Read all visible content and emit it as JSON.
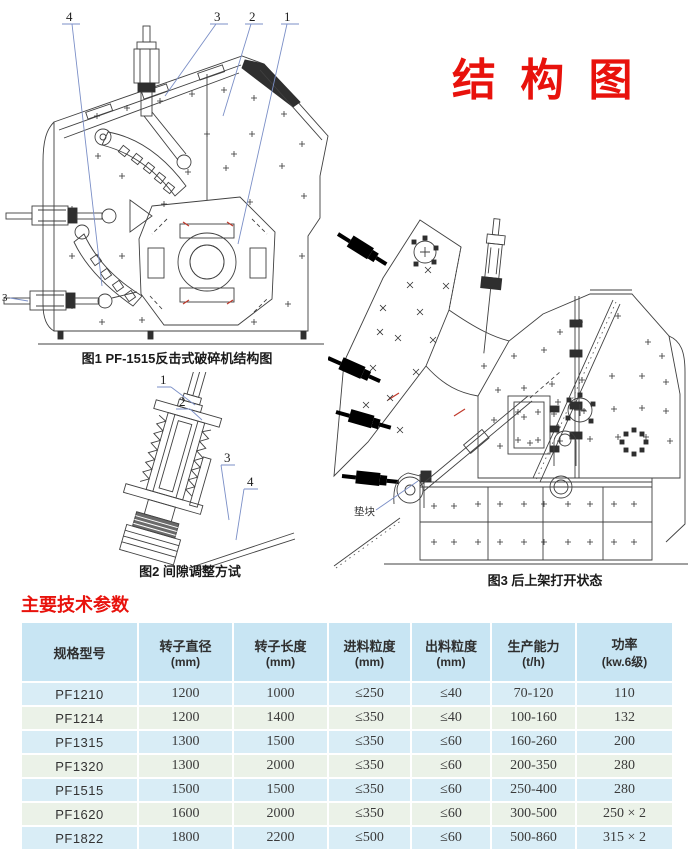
{
  "title": "结 构 图",
  "figures": {
    "fig1": {
      "caption": "图1 PF-1515反击式破碎机结构图",
      "callout_4": "4",
      "callout_3": "3",
      "callout_2": "2",
      "callout_1": "1",
      "callout_left_3": "3"
    },
    "fig2": {
      "caption": "图2 间隙调整方试",
      "callout_1": "1",
      "callout_2": "2",
      "callout_3": "3",
      "callout_4": "4"
    },
    "fig3": {
      "caption": "图3 后上架打开状态",
      "pad_label": "垫块"
    }
  },
  "section_heading": "主要技术参数",
  "table": {
    "headers": [
      {
        "title": "规格型号",
        "unit": ""
      },
      {
        "title": "转子直径",
        "unit": "(mm)"
      },
      {
        "title": "转子长度",
        "unit": "(mm)"
      },
      {
        "title": "进料粒度",
        "unit": "(mm)"
      },
      {
        "title": "出料粒度",
        "unit": "(mm)"
      },
      {
        "title": "生产能力",
        "unit": "(t/h)"
      },
      {
        "title": "功率",
        "unit": "(kw.6级)"
      }
    ],
    "rows": [
      [
        "PF1210",
        "1200",
        "1000",
        "≤250",
        "≤40",
        "70-120",
        "110"
      ],
      [
        "PF1214",
        "1200",
        "1400",
        "≤350",
        "≤40",
        "100-160",
        "132"
      ],
      [
        "PF1315",
        "1300",
        "1500",
        "≤350",
        "≤60",
        "160-260",
        "200"
      ],
      [
        "PF1320",
        "1300",
        "2000",
        "≤350",
        "≤60",
        "200-350",
        "280"
      ],
      [
        "PF1515",
        "1500",
        "1500",
        "≤350",
        "≤60",
        "250-400",
        "280"
      ],
      [
        "PF1620",
        "1600",
        "2000",
        "≤350",
        "≤60",
        "300-500",
        "250 × 2"
      ],
      [
        "PF1822",
        "1800",
        "2200",
        "≤500",
        "≤60",
        "500-860",
        "315 × 2"
      ]
    ]
  },
  "colors": {
    "accent_red": "#e8120c",
    "table_header_bg": "#c8e5f3",
    "row_blue": "#d9edf6",
    "row_green": "#ebf2e8",
    "leader_blue": "#7b8fc7"
  }
}
